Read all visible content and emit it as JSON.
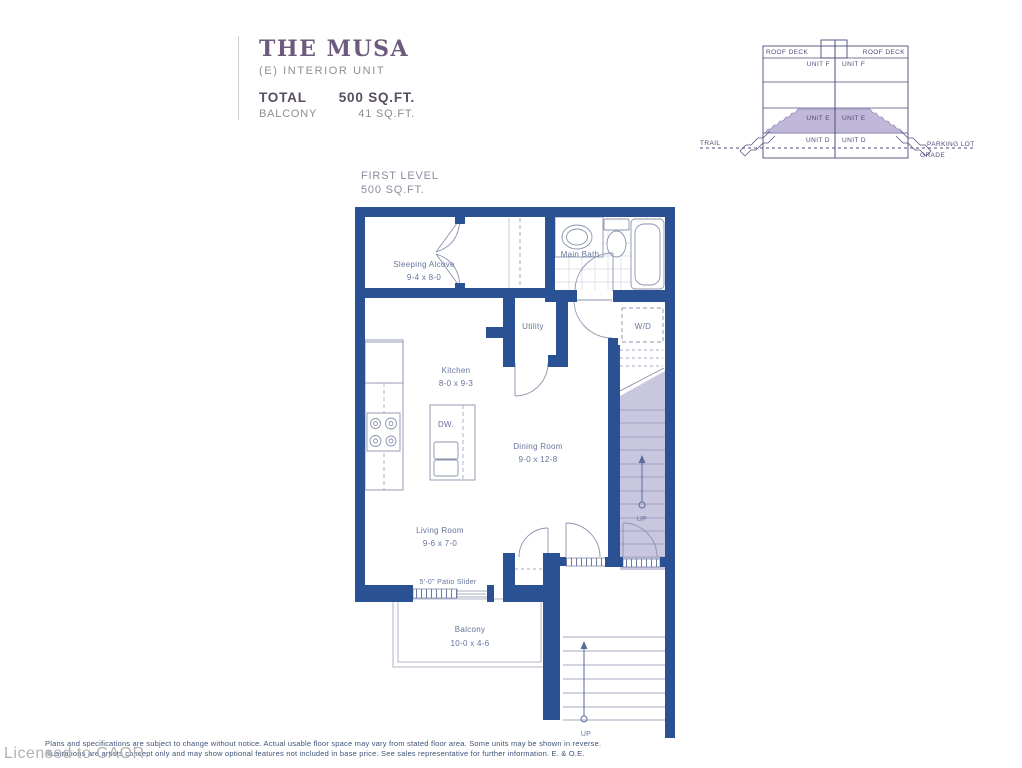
{
  "header": {
    "title": "THE MUSA",
    "subtitle": "(E) INTERIOR UNIT",
    "total_label": "TOTAL",
    "total_value": "500 SQ.FT.",
    "balcony_label": "BALCONY",
    "balcony_value": "41 SQ.FT."
  },
  "level": {
    "label": "FIRST LEVEL",
    "area": "500 SQ.FT."
  },
  "cross_section": {
    "roof_deck_left": "ROOF DECK",
    "roof_deck_right": "ROOF DECK",
    "unit_f_left": "UNIT F",
    "unit_f_right": "UNIT F",
    "unit_e_left": "UNIT E",
    "unit_e_right": "UNIT E",
    "unit_d_left": "UNIT D",
    "unit_d_right": "UNIT D",
    "trail": "TRAIL",
    "parking_lot": "PARKING LOT",
    "grade": "GRADE",
    "highlight_color": "#b6aad1"
  },
  "rooms": {
    "sleeping_alcove": {
      "name": "Sleeping Alcove",
      "dims": "9-4 x 8-0"
    },
    "main_bath": {
      "name": "Main Bath"
    },
    "utility": {
      "name": "Utility"
    },
    "washer_dryer": {
      "name": "W/D"
    },
    "kitchen": {
      "name": "Kitchen",
      "dims": "8-0 x 9-3"
    },
    "dishwasher": {
      "name": "DW."
    },
    "dining_room": {
      "name": "Dining Room",
      "dims": "9-0 x 12-8"
    },
    "living_room": {
      "name": "Living Room",
      "dims": "9-6 x 7-0"
    },
    "patio_slider": {
      "name": "5'-0\" Patio Slider"
    },
    "balcony": {
      "name": "Balcony",
      "dims": "10-0 x 4-6"
    },
    "stairs_interior_up": "UP",
    "stairs_exterior_up": "UP"
  },
  "colors": {
    "wall": "#2a5194",
    "fixture_line": "#8b93ae",
    "stair_fill": "#c9c6e0",
    "title_purple": "#6e5a7d"
  },
  "footer": {
    "line1": "Plans and specifications are subject to change without notice.  Actual usable floor space may vary from stated floor area.  Some units may be shown in reverse.",
    "line2": "Illustrations are artists concept only and may show optional features not included in base price.  See sales representative for further information. E. & O.E.",
    "license": "Licensed to CAOR"
  }
}
